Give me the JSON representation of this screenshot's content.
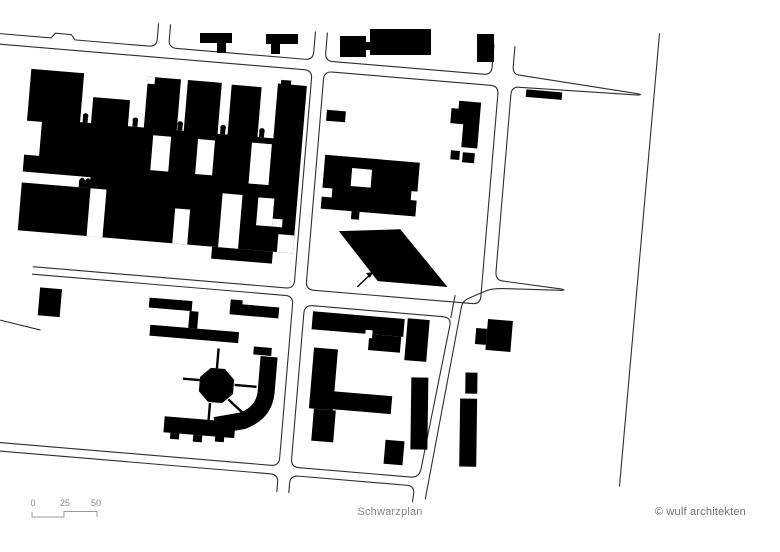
{
  "footer": {
    "title": "Schwarzplan",
    "credit": "© wulf architekten",
    "scale_labels": [
      "0",
      "25",
      "50"
    ]
  },
  "map": {
    "label": "Schwarzplan figure-ground site plan",
    "highlight": "parallelogram-building",
    "arrow_icon": "northeast-arrow"
  },
  "colors": {
    "background": "#ffffff",
    "building": "#000000",
    "street_line": "#2e2e2e",
    "text": "#868686"
  }
}
